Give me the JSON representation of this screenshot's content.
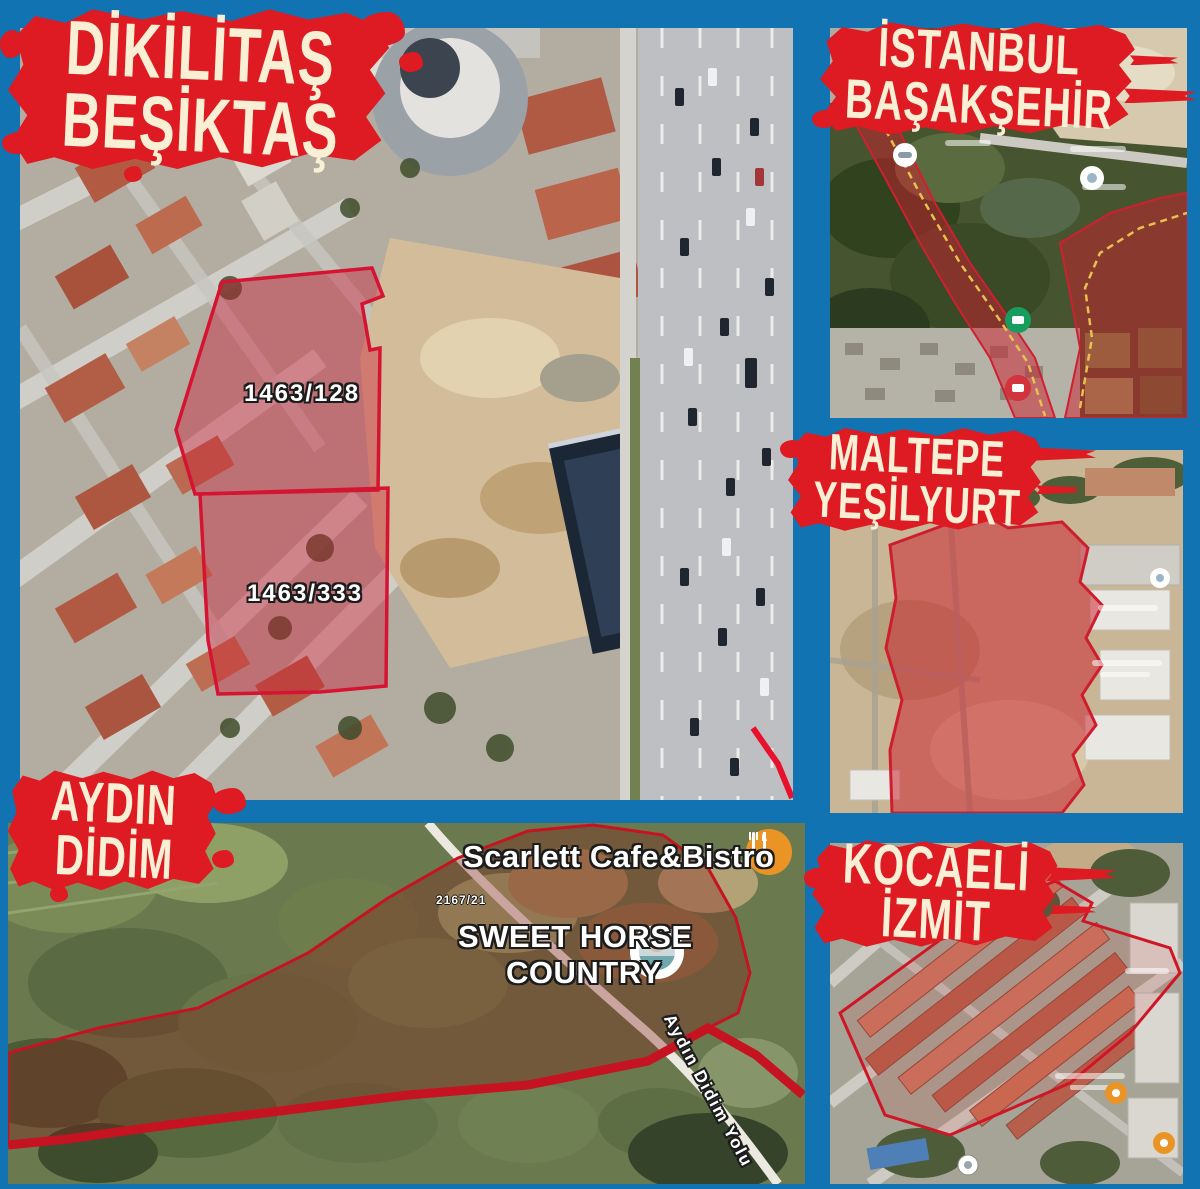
{
  "page": {
    "colors": {
      "background": "#1173b2",
      "banner_red": "#de1a22",
      "banner_text_cream": "#f9efd4",
      "parcel_overlay_red": "#d41432"
    }
  },
  "panels": {
    "besiktas": {
      "title": [
        "DİKİLİTAŞ",
        "BEŞİKTAŞ"
      ],
      "parcel_labels": [
        "1463/128",
        "1463/333"
      ]
    },
    "basaksehir": {
      "title": [
        "İSTANBUL",
        "BAŞAKŞEHİR"
      ]
    },
    "maltepe": {
      "title": [
        "MALTEPE",
        "YEŞİLYURT"
      ]
    },
    "didim": {
      "title": [
        "AYDIN",
        "DİDİM"
      ],
      "parcel_label": "2167/21",
      "road_label": "Aydın Didim Yolu",
      "pois": [
        {
          "name": "Scarlett Cafe&Bistro",
          "icon": "restaurant-pin-icon"
        },
        {
          "name_line1": "SWEET HORSE",
          "name_line2": "COUNTRY",
          "icon": "location-pin-icon"
        }
      ]
    },
    "kocaeli": {
      "title": [
        "KOCAELİ",
        "İZMİT"
      ]
    }
  }
}
